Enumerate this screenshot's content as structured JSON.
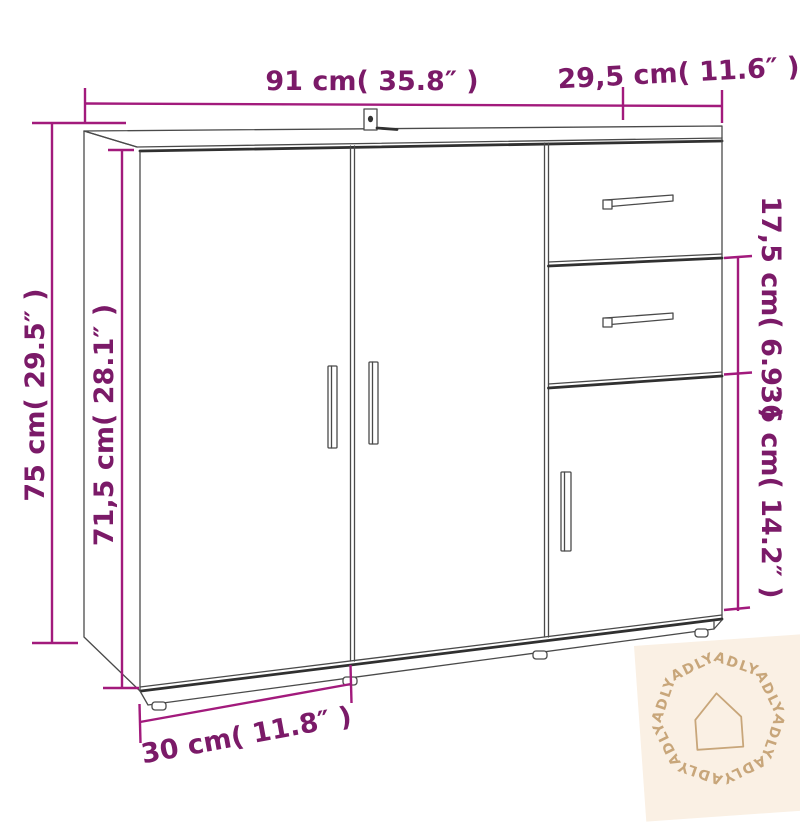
{
  "title": "Sideboard dimension diagram",
  "dimensions": {
    "top_width": "91 cm( 35.8″ )",
    "top_depth": "29,5 cm( 11.6″ )",
    "total_height": "75 cm( 29.5″ )",
    "body_height": "71,5 cm( 28.1″ )",
    "drawer_section_height": "17,5 cm( 6.9″ )",
    "lower_door_height": "36 cm( 14.2″ )",
    "bottom_depth": "30 cm( 11.8″ )"
  },
  "watermark": {
    "brand": "ADLY"
  },
  "colors": {
    "dimension_line": "#a21a7c",
    "dimension_text": "#7b1a68",
    "line_art": "#4a4a4a",
    "watermark_bg": "#faf0e4",
    "watermark_fg": "#c8a67a",
    "background": "#ffffff"
  }
}
